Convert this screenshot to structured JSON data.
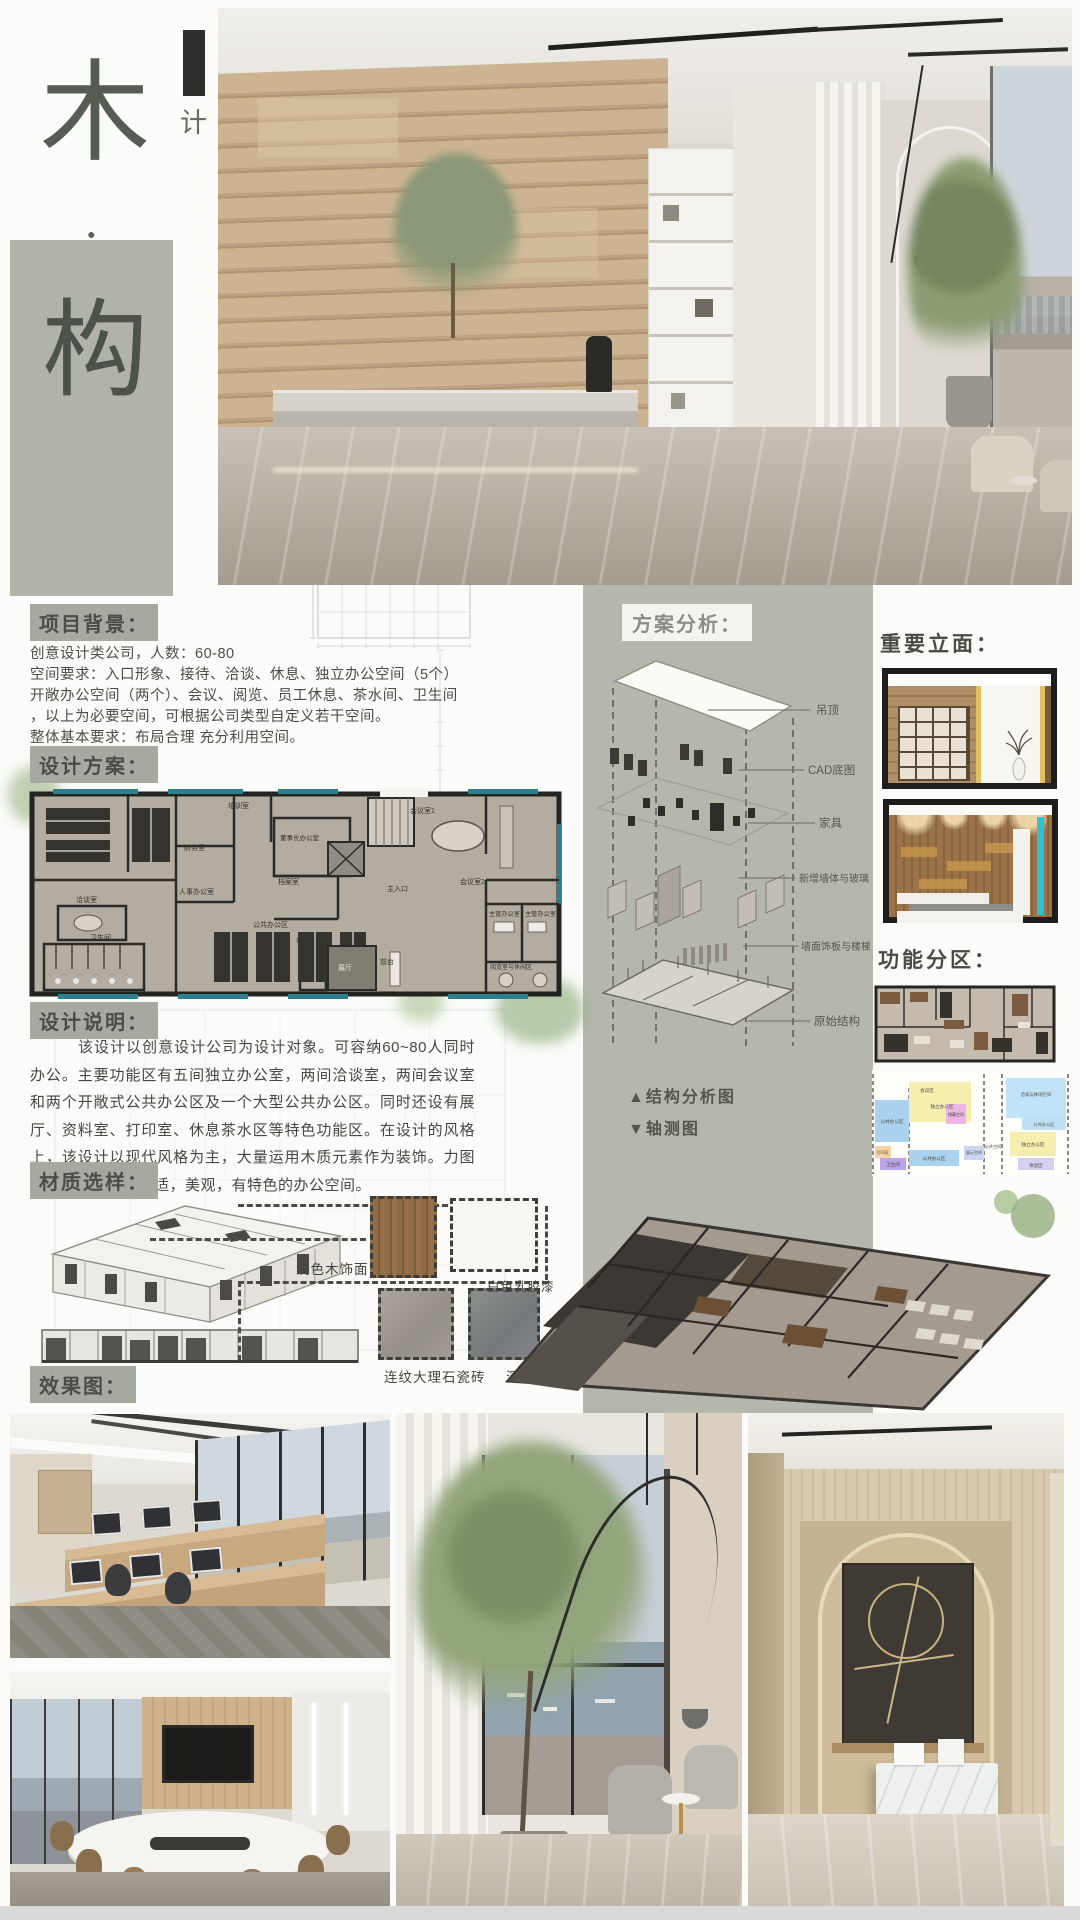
{
  "title": {
    "char1": "木",
    "dot": "·",
    "char2": "构",
    "subtitle": "设计类公司现代风办公空间设计"
  },
  "bg": {
    "heading": "项目背景：",
    "l1": "创意设计类公司，人数：60-80",
    "l2": "空间要求：入口形象、接待、洽谈、休息、独立办公空间（5个）",
    "l3": "开敞办公空间（两个）、会议、阅览、员工休息、茶水间、卫生间",
    "l4": "，以上为必要空间，可根据公司类型自定义若干空间。",
    "l5": "整体基本要求：布局合理 充分利用空间。"
  },
  "plan": {
    "heading": "设计方案：",
    "r1": "培训室",
    "r2": "财务室",
    "r3": "人事办公室",
    "r4": "董事长办公室",
    "r5": "档案室",
    "r6": "主入口",
    "r7": "会议室1",
    "r8": "会议室2",
    "r9": "洽谈室",
    "r10": "卫生间",
    "r11": "公共办公区",
    "r12": "茶水间",
    "r13": "展厅",
    "r14": "前台",
    "r15": "主管办公室",
    "r16": "主管办公室",
    "r17": "阅览室与休闲区"
  },
  "analysis": {
    "heading": "方案分析：",
    "l1": "吊顶",
    "l2": "CAD底图",
    "l3": "家具",
    "l4": "新增墙体与玻璃",
    "l5": "墙面饰板与楼梯",
    "l6": "原始结构",
    "cap1": "▲结构分析图",
    "cap2": "▼轴测图"
  },
  "elev": {
    "heading": "重要立面："
  },
  "zone": {
    "heading": "功能分区：",
    "z1": "公共办公区",
    "z2": "独立办公区",
    "z3": "储藏空间",
    "z4": "打印区",
    "z5": "卫生间",
    "z6": "公共办公区",
    "z7": "展示空间",
    "z8": "公共空间",
    "z9": "洽谈与休闲空间",
    "z10": "公共办公区",
    "z11": "独立办公区",
    "z12": "休息区",
    "z13": "会议区"
  },
  "desc": {
    "heading": "设计说明：",
    "text": "该设计以创意设计公司为设计对象。可容纳60~80人同时办公。主要功能区有五间独立办公室，两间洽谈室，两间会议室和两个开敞式公共办公区及一个大型公共办公区。同时还设有展厅、资料室、打印室、休息茶水区等特色功能区。在设计的风格上，该设计以现代风格为主，大量运用木质元素作为装饰。力图打造一个高效，舒适，美观，有特色的办公空间。"
  },
  "mat": {
    "heading": "材质选样：",
    "m1": "浅色木饰面",
    "m2": "白色乳胶漆",
    "m3": "连纹大理石瓷砖",
    "m4": "深色瓷砖"
  },
  "fx": {
    "heading": "效果图："
  },
  "colors": {
    "panel": "#b5b7ac",
    "heading_bg": "#a6a99f",
    "heading_text": "#4b4e46",
    "accent_teal": "#2d7f8e",
    "swatch_wood": "#8f6b46",
    "swatch_white": "#f7f6f2",
    "swatch_marble": "#a19c95",
    "swatch_dark": "#7f8284"
  }
}
